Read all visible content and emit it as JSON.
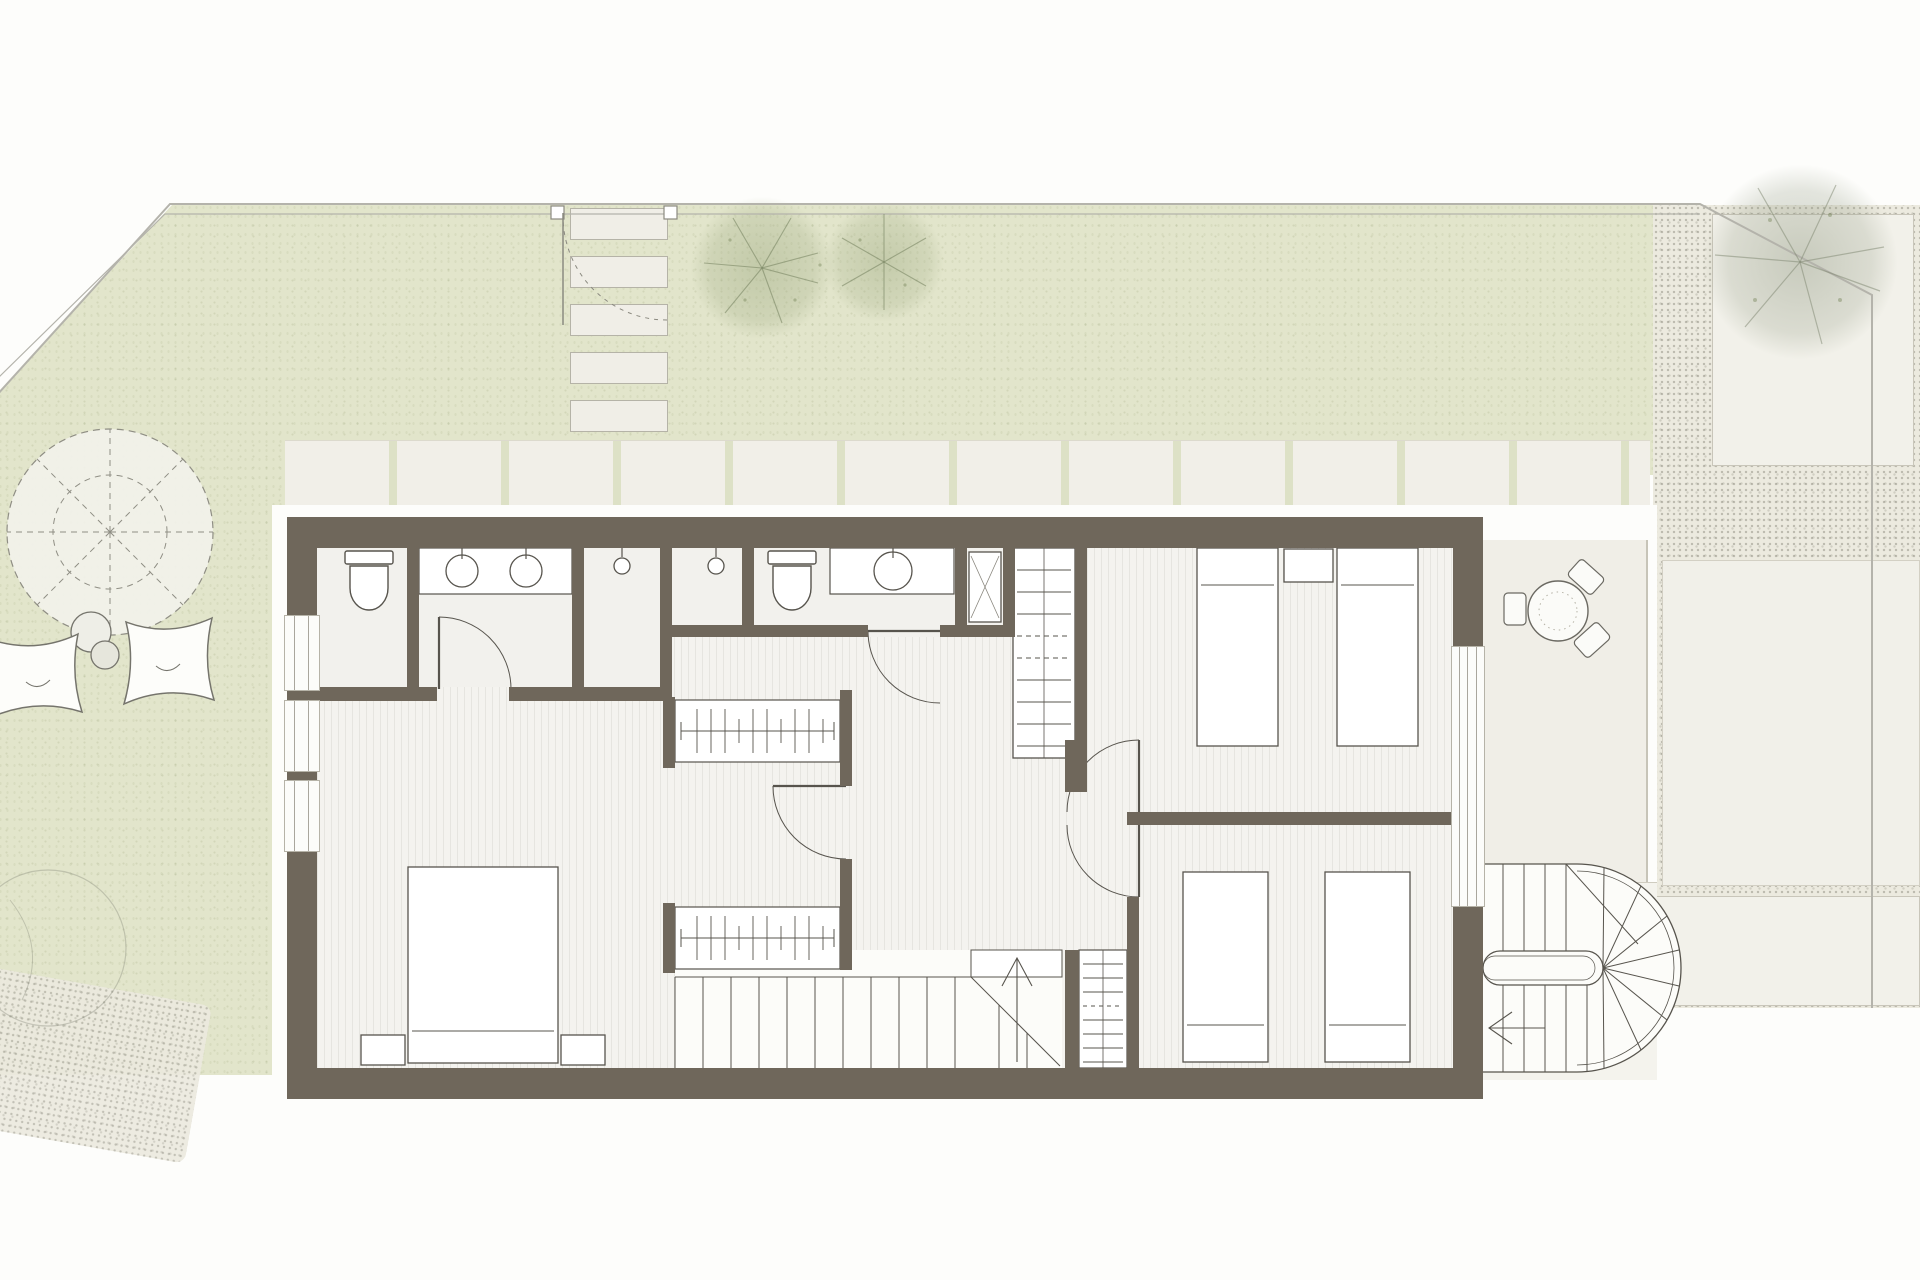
{
  "watermark": {
    "line1": "COSTA GRUP",
    "line2": "ESTATES"
  },
  "palette": {
    "wall": "#6f675b",
    "garden_green": "#e2e5cb",
    "paving": "#f1efe8",
    "floor": "#f4f3ef",
    "linework": "#57544d",
    "tree_green": "#97a47a"
  },
  "plan_elements": [
    "garden",
    "boundary-fence",
    "garden-gate",
    "stepping-stones",
    "patio-slabs",
    "parasol",
    "butterfly-chairs",
    "side-tables",
    "trees",
    "master-bedroom-bed",
    "nightstands",
    "wardrobes",
    "main-staircase",
    "ensuite-toilet",
    "double-vanity",
    "shower-heads",
    "family-toilet",
    "vanity",
    "shower-tray",
    "linen-closet",
    "utility-closet",
    "twin-beds-top-room",
    "twin-beds-bottom-room",
    "terrace",
    "terrace-table",
    "terrace-chairs",
    "spiral-staircase",
    "gravel-path"
  ]
}
